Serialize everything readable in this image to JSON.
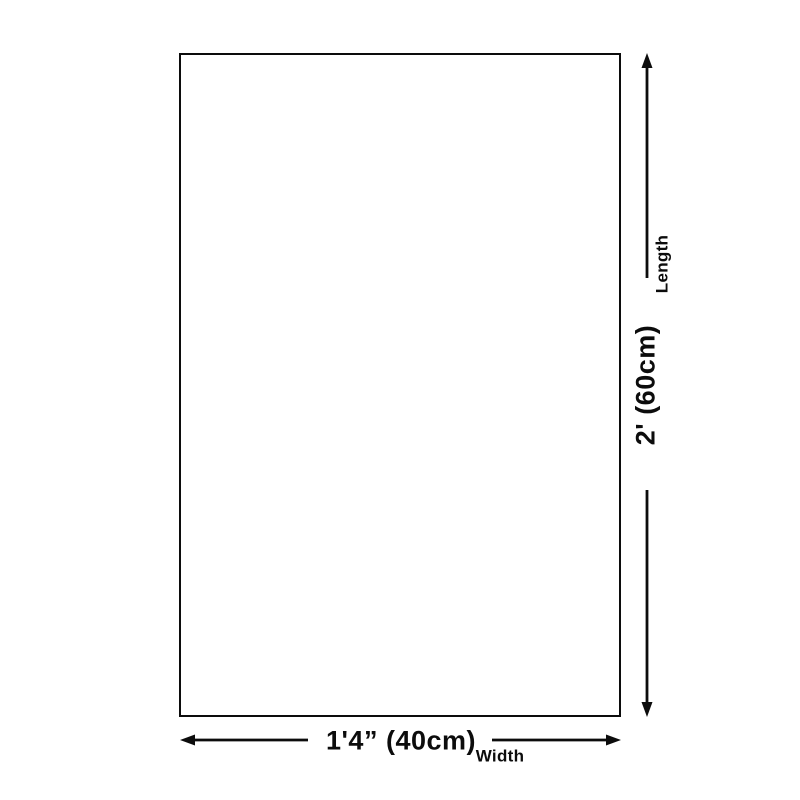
{
  "diagram": {
    "type": "product-dimension-diagram",
    "background_color": "#ffffff",
    "line_color": "#0c0c0c",
    "shape": "rectangle",
    "vertical_dimension": {
      "label": "Length",
      "value": "2' (60cm)"
    },
    "horizontal_dimension": {
      "label": "Width",
      "value": "1'4” (40cm)"
    }
  }
}
